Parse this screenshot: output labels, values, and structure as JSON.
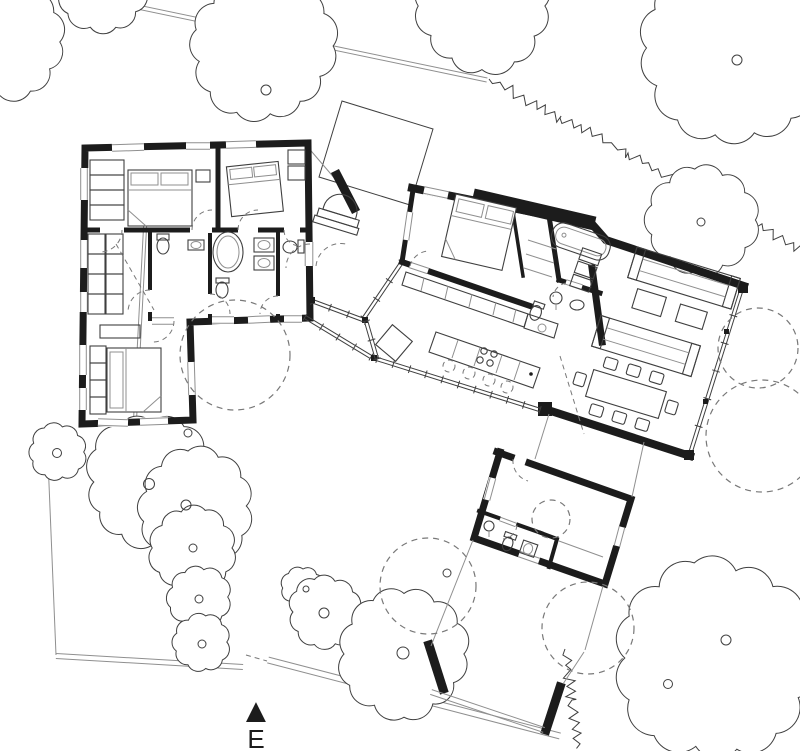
{
  "compass": {
    "label": "E"
  },
  "icons": {
    "north_arrow": "▲"
  },
  "colors": {
    "ink": "#1c1c1c",
    "line": "#3f3f3f",
    "soft": "#8f8f8f",
    "paper": "#ffffff"
  }
}
